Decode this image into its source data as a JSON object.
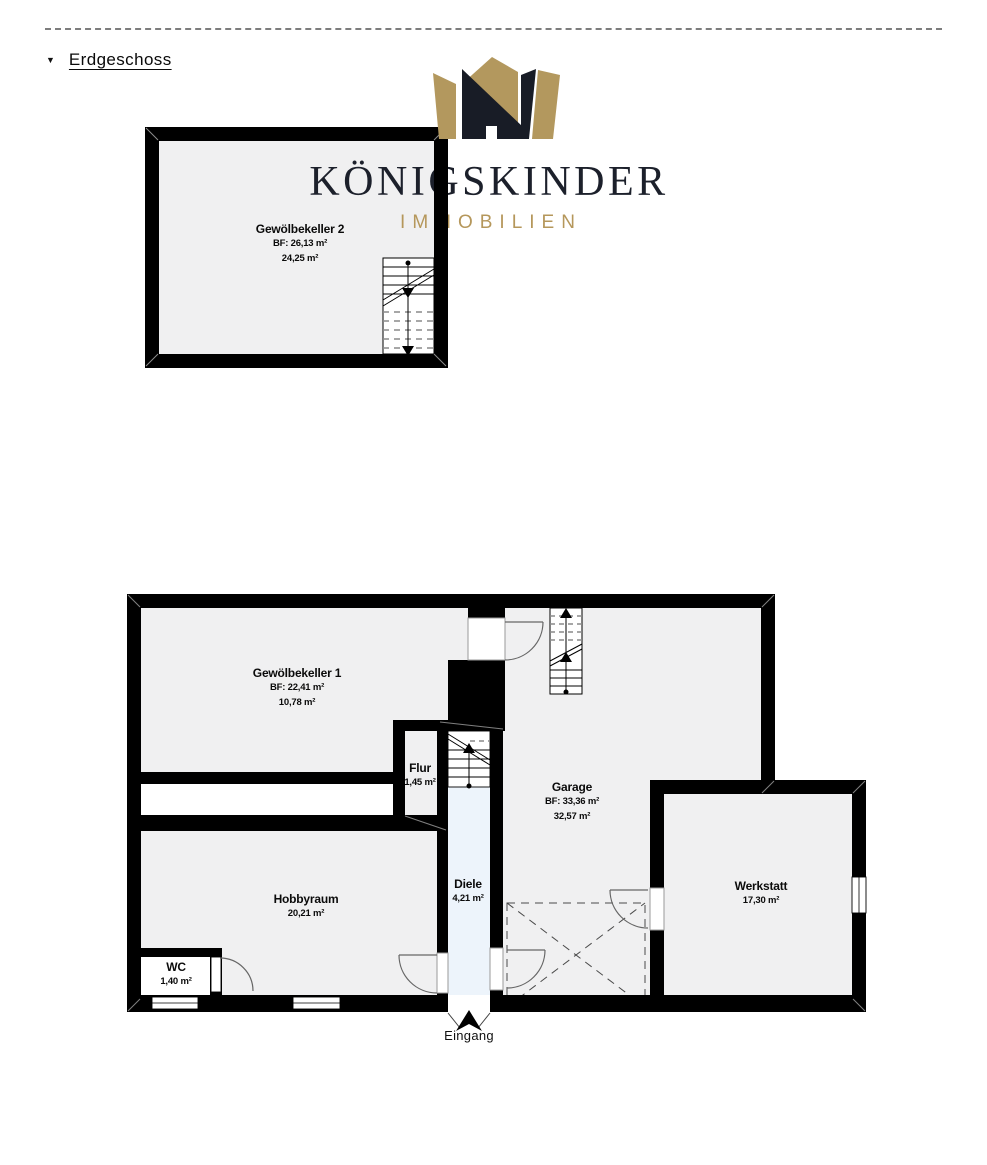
{
  "header": {
    "collapse_icon": "▼",
    "title": "Erdgeschoss"
  },
  "logo": {
    "title": "KÖNIGSKINDER",
    "subtitle": "IMMOBILIEN",
    "gold_color": "#b3985e",
    "dark_color": "#181c26"
  },
  "colors": {
    "wall": "#000000",
    "room_fill": "#f0f0f1",
    "diele_fill": "#edf4fb",
    "dash_line": "#7d7d7d"
  },
  "plans": {
    "upper": {
      "gewoelbekeller2": {
        "name": "Gewölbekeller 2",
        "bf": "BF: 26,13 m²",
        "area": "24,25 m²"
      }
    },
    "lower": {
      "gewoelbekeller1": {
        "name": "Gewölbekeller 1",
        "bf": "BF: 22,41 m²",
        "area": "10,78 m²"
      },
      "flur": {
        "name": "Flur",
        "area": "1,45 m²"
      },
      "garage": {
        "name": "Garage",
        "bf": "BF: 33,36 m²",
        "area": "32,57 m²"
      },
      "diele": {
        "name": "Diele",
        "area": "4,21 m²"
      },
      "hobbyraum": {
        "name": "Hobbyraum",
        "area": "20,21 m²"
      },
      "wc": {
        "name": "WC",
        "area": "1,40 m²"
      },
      "werkstatt": {
        "name": "Werkstatt",
        "area": "17,30 m²"
      },
      "entrance": {
        "label": "Eingang"
      }
    }
  }
}
